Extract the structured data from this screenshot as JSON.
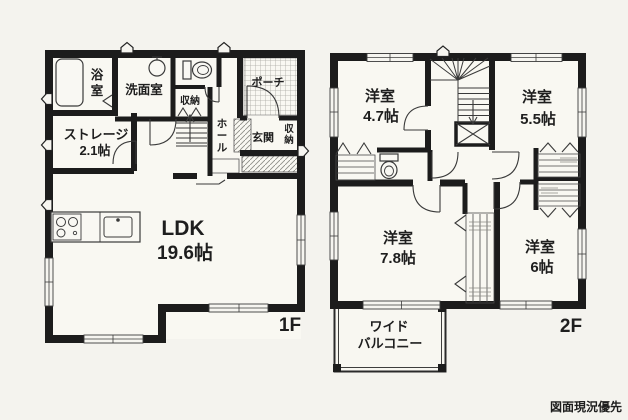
{
  "credit": "図面現況優先",
  "floor1": {
    "label": "1F",
    "rooms": {
      "ldk": {
        "name": "LDK",
        "size": "19.6帖"
      },
      "storage": {
        "name": "ストレージ",
        "size": "2.1帖"
      },
      "bath": {
        "name": "浴室"
      },
      "washroom": {
        "name": "洗面室"
      },
      "hall": {
        "name": "ホール"
      },
      "entrance": {
        "name": "玄関"
      },
      "porch": {
        "name": "ポーチ"
      },
      "closet_by_toilet": {
        "name": "収納"
      },
      "entrance_closet": {
        "name": "収納"
      }
    }
  },
  "floor2": {
    "label": "2F",
    "rooms": {
      "bedroom_nw": {
        "name": "洋室",
        "size": "4.7帖"
      },
      "bedroom_ne": {
        "name": "洋室",
        "size": "5.5帖"
      },
      "bedroom_sw": {
        "name": "洋室",
        "size": "7.8帖"
      },
      "bedroom_se": {
        "name": "洋室",
        "size": "6帖"
      },
      "balcony": {
        "name_line1": "ワイド",
        "name_line2": "バルコニー"
      }
    }
  },
  "colors": {
    "wall": "#1c1c1c",
    "paper": "#f4f3ee",
    "thin_line": "#3a3a3a"
  }
}
